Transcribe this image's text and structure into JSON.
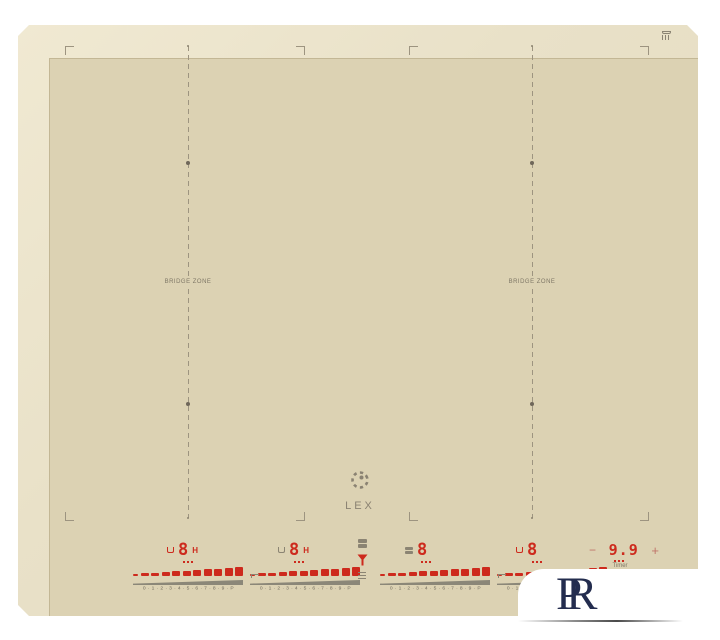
{
  "colors": {
    "background": "#ffffff",
    "glass": "#dcd2b3",
    "bevel": "#e9e1c8",
    "accent_red": "#cd2a1d",
    "marking_gray": "#8b8473",
    "watermark_navy": "#232c4e"
  },
  "hob": {
    "brand": "LEX",
    "bridge_zone_left_label": "BRIDGE ZONE",
    "bridge_zone_right_label": "BRIDGE ZONE",
    "icons": {
      "top_right": "pan-detection-icon",
      "brand_mark": "lex-ring-icon"
    }
  },
  "control_panel": {
    "zones": [
      {
        "digit": "8",
        "right_label": "H",
        "left_icon": "pot-icon-red"
      },
      {
        "digit": "8",
        "right_label": "H",
        "left_icon": "pot-icon-gray"
      },
      {
        "digit": "8",
        "right_label": "",
        "left_icon": "bridge-icon"
      },
      {
        "digit": "8",
        "right_label": "",
        "left_icon": "pot-icon-red"
      }
    ],
    "power_scale": "0 · 1 · 2 · 3 · 4 · 5 · 6 · 7 · 8 · 9 · P",
    "function_icons": [
      "bridge-icon",
      "boost-icon",
      "lock-icon"
    ],
    "timer": {
      "minus": "−",
      "value": "9.9",
      "plus": "+",
      "label": "Timer"
    }
  },
  "watermark": {
    "letter_p": "P",
    "letter_r": "R"
  }
}
